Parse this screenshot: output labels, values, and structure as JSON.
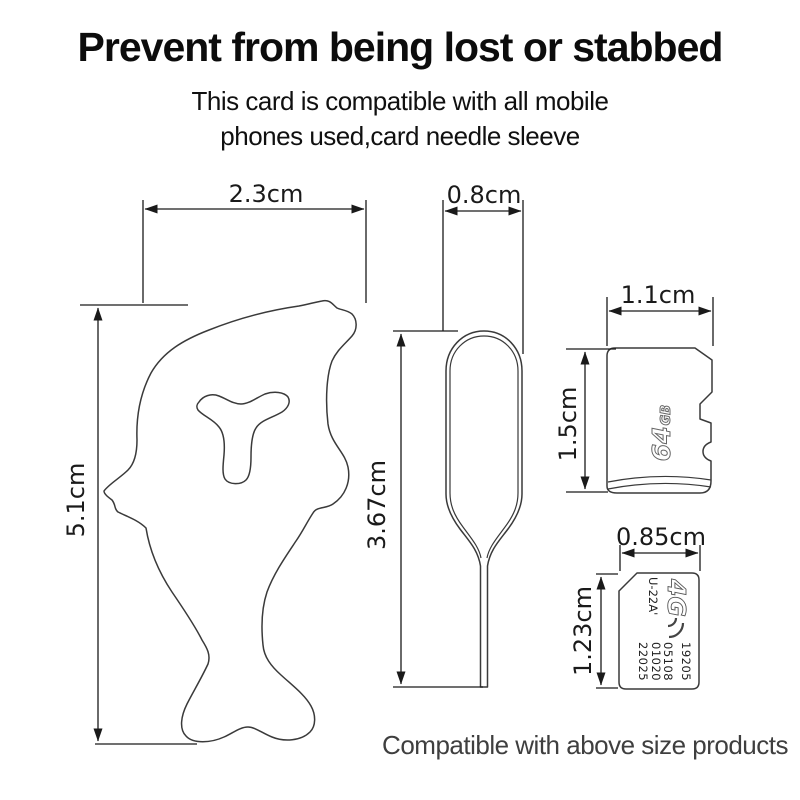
{
  "header": {
    "title": "Prevent from being lost or stabbed",
    "subtitle_line1": "This card is compatible with all mobile",
    "subtitle_line2": "phones used,card needle sleeve"
  },
  "footer": {
    "note": "Compatible with above size products"
  },
  "diagram": {
    "sleeve": {
      "width_label": "2.3cm",
      "height_label": "5.1cm"
    },
    "pin": {
      "width_label": "0.8cm",
      "height_label": "3.67cm"
    },
    "sd_card": {
      "width_label": "1.1cm",
      "height_label": "1.5cm",
      "capacity_number": "64",
      "capacity_unit": "GB"
    },
    "sim_card": {
      "width_label": "0.85cm",
      "height_label": "1.23cm",
      "logo": "4G",
      "model": "U-22A'",
      "serial_lines": [
        "19205",
        "05108",
        "01020",
        "22025"
      ]
    }
  },
  "colors": {
    "line": "#1a1a1a",
    "outline": "#3a3a3a",
    "title_text": "#0c0c0c",
    "footer_text": "#3f3f3f"
  }
}
